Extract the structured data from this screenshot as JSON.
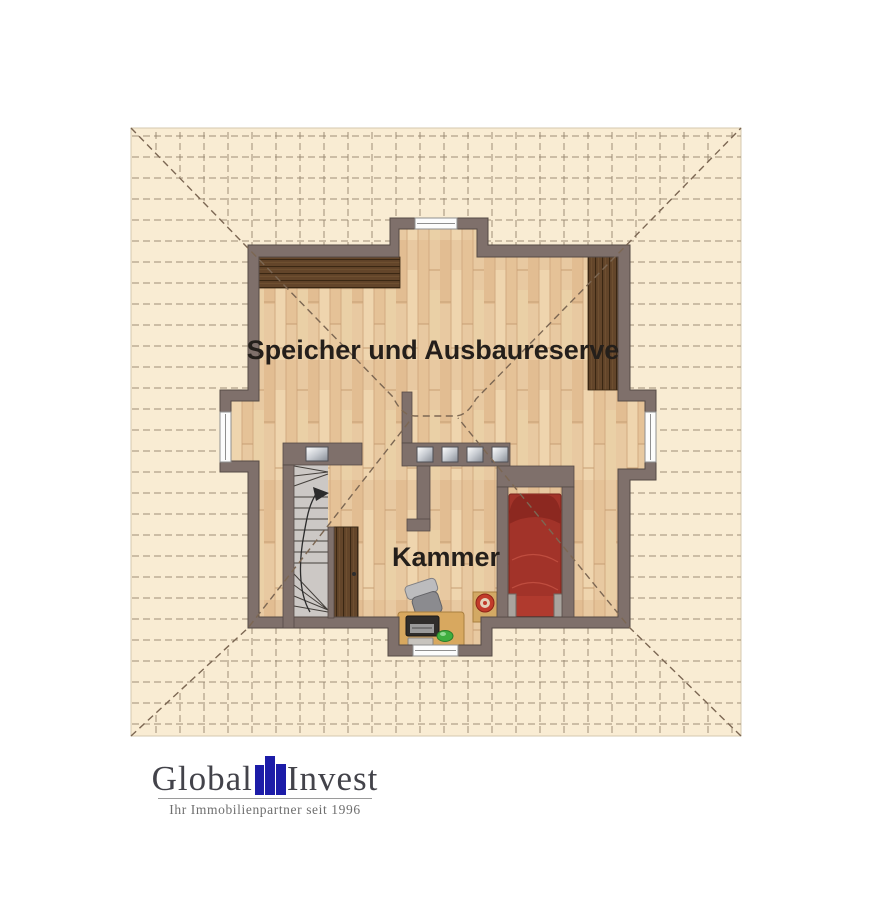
{
  "plan": {
    "labels": {
      "attic": "Speicher und Ausbaureserve",
      "chamber": "Kammer"
    }
  },
  "logo": {
    "word_left": "Global",
    "word_right": "Invest",
    "tagline": "Ihr Immobilienpartner seit 1996"
  },
  "colors": {
    "plan_background": "#f9ecd3",
    "grid_line": "#94846d",
    "hip_line": "#7c6753",
    "wall": "#7f706b",
    "floor_wood": "#e8c9a1",
    "roof_wood_dark": "#63452a",
    "bed_red": "#a23329",
    "desk_tan": "#d8a85f",
    "stair_floor": "#ccc8c5",
    "logo_blue": "#1c1ca8"
  }
}
